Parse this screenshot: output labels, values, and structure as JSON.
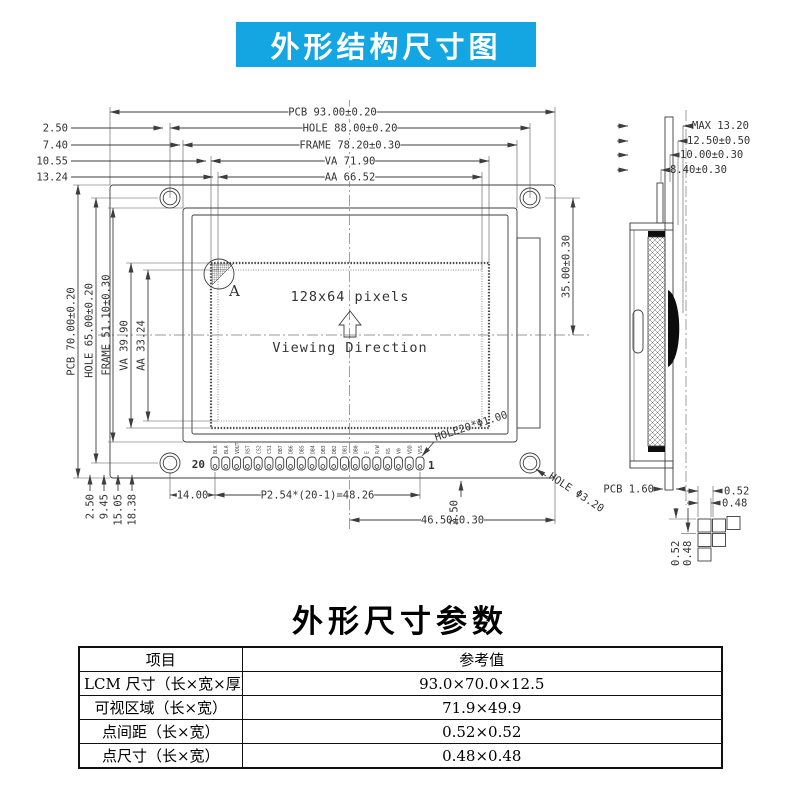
{
  "banner": {
    "title": "外形结构尺寸图"
  },
  "colors": {
    "banner_bg": "#14a6e2",
    "line": "#3d3d3d"
  },
  "drawing": {
    "top_dims": [
      "PCB 93.00±0.20",
      "HOLE 88.00±0.20",
      "FRAME 78.20±0.30",
      "VA 71.90",
      "AA 66.52"
    ],
    "top_offsets": [
      "2.50",
      "7.40",
      "10.55",
      "13.24"
    ],
    "left_dims": [
      "PCB 70.00±0.20",
      "HOLE 65.00±0.20",
      "FRAME 51.10±0.30",
      "VA 39.90",
      "AA 33.24"
    ],
    "right_dim": "35.00±0.30",
    "display_label": "128x64 pixels",
    "viewing_label": "Viewing Direction",
    "detail_label": "A",
    "pin_start": "20",
    "pin_end": "1",
    "pin_labels": [
      "BLK",
      "BLA",
      "VOUT",
      "RST",
      "CS2",
      "CS1",
      "DB7",
      "DB6",
      "DB5",
      "DB4",
      "DB3",
      "DB2",
      "DB1",
      "DB0",
      "E",
      "R/W",
      "RS",
      "V0",
      "VDD",
      "VSS"
    ],
    "pin_hole_label": "HOLE20*Φ1.00",
    "mount_hole_label": "HOLE Φ3.20",
    "bottom_offsets": [
      "2.50",
      "9.45",
      "15.05",
      "18.38"
    ],
    "bottom_dims": [
      "14.00",
      "P2.54*(20-1)=48.26",
      "2.50",
      "46.50±0.30"
    ],
    "side_dims": [
      "MAX 13.20",
      "12.50±0.50",
      "10.00±0.30",
      "8.40±0.30"
    ],
    "side_pcb_label": "PCB 1.60",
    "pixel_detail": {
      "top": [
        "0.52",
        "0.48"
      ],
      "left": [
        "0.52",
        "0.48"
      ]
    }
  },
  "section": {
    "title": "外形尺寸参数"
  },
  "table": {
    "headers": [
      "项目",
      "参考值"
    ],
    "rows": [
      [
        "LCM 尺寸（长×宽×厚）",
        "93.0×70.0×12.5"
      ],
      [
        "可视区域（长×宽）",
        "71.9×49.9"
      ],
      [
        "点间距（长×宽）",
        "0.52×0.52"
      ],
      [
        "点尺寸（长×宽）",
        "0.48×0.48"
      ]
    ]
  }
}
